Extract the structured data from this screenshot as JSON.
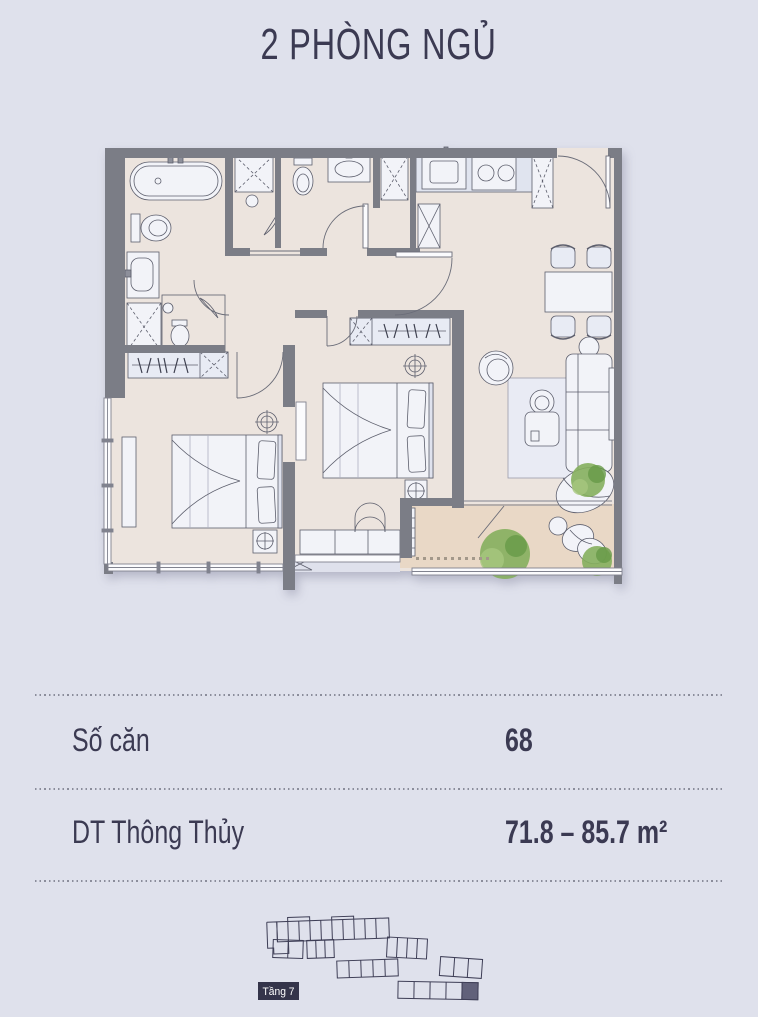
{
  "title": "2 PHÒNG NGỦ",
  "info": {
    "rows": [
      {
        "label": "Số căn",
        "value": "68"
      },
      {
        "label": "DT Thông Thủy",
        "value": "71.8 – 85.7 m²"
      }
    ]
  },
  "key_plan": {
    "floor_label": "Tầng 7"
  },
  "colors": {
    "bg": "#dfe1ec",
    "ink": "#3b3a52",
    "wall": "#7b7d86",
    "floor": "#ece4de",
    "balcony": "#e9d8c6",
    "fixture": "#f2f3f8",
    "furniture": "#e8ebf4",
    "plant": "#85af5d",
    "plant2": "#679a47",
    "keyline": "#3e3e56",
    "unithl": "#61617a",
    "labelbox": "#34344a"
  }
}
